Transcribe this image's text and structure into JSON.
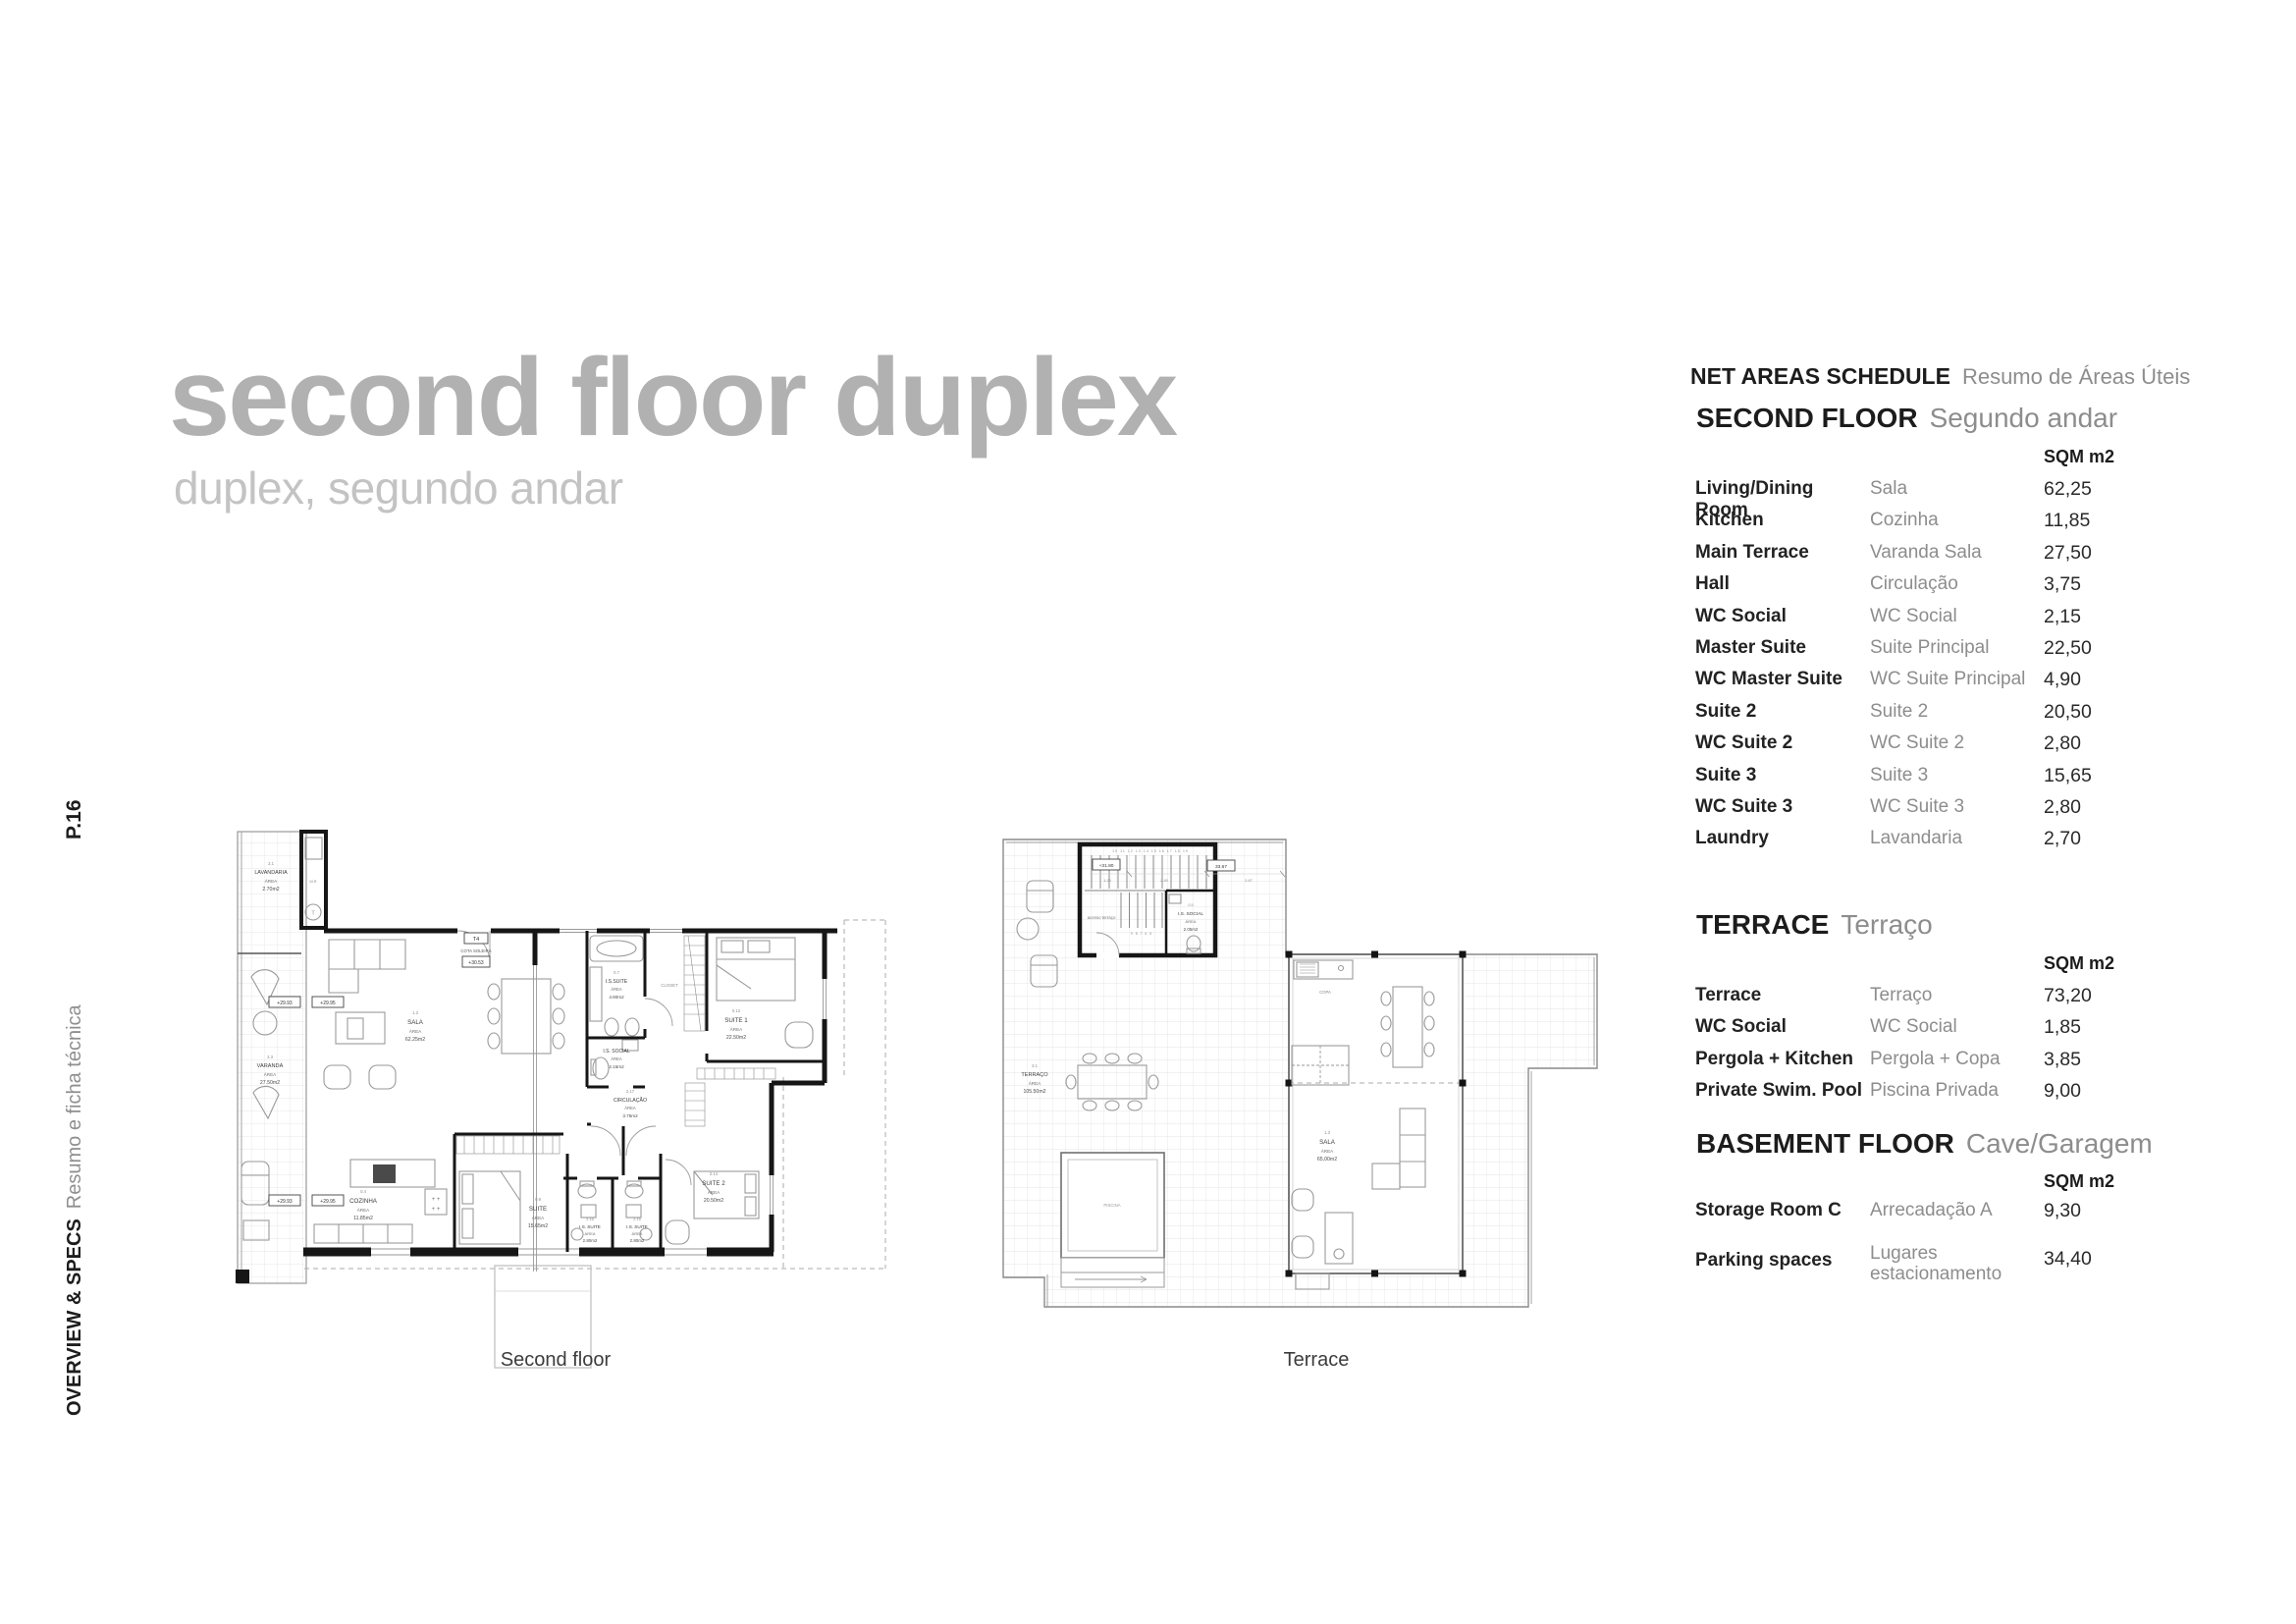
{
  "page": {
    "title": "second floor duplex",
    "subtitle": "duplex, segundo andar"
  },
  "sidebar": {
    "page_number": "P.16",
    "section_en": "OVERVIEW & SPECS",
    "section_pt": "Resumo e ficha técnica"
  },
  "schedule": {
    "title_en": "NET AREAS SCHEDULE",
    "title_pt": "Resumo de Áreas Úteis",
    "sqm_label": "SQM m2",
    "sections": [
      {
        "name_en": "SECOND FLOOR",
        "name_pt": "Segundo andar",
        "rows": [
          [
            "Living/Dining Room",
            "Sala",
            "62,25"
          ],
          [
            "Kitchen",
            "Cozinha",
            "11,85"
          ],
          [
            "Main Terrace",
            "Varanda Sala",
            "27,50"
          ],
          [
            "Hall",
            "Circulação",
            "3,75"
          ],
          [
            "WC Social",
            "WC Social",
            "2,15"
          ],
          [
            "Master Suite",
            "Suite Principal",
            "22,50"
          ],
          [
            "WC Master Suite",
            "WC Suite Principal",
            "4,90"
          ],
          [
            "Suite 2",
            "Suite 2",
            "20,50"
          ],
          [
            "WC Suite 2",
            "WC Suite 2",
            "2,80"
          ],
          [
            "Suite 3",
            "Suite 3",
            "15,65"
          ],
          [
            "WC Suite 3",
            "WC Suite 3",
            "2,80"
          ],
          [
            "Laundry",
            "Lavandaria",
            "2,70"
          ]
        ]
      },
      {
        "name_en": "TERRACE",
        "name_pt": "Terraço",
        "rows": [
          [
            "Terrace",
            "Terraço",
            "73,20"
          ],
          [
            "WC Social",
            "WC Social",
            "1,85"
          ],
          [
            "Pergola + Kitchen",
            "Pergola + Copa",
            "3,85"
          ],
          [
            "Private Swim. Pool",
            "Piscina Privada",
            "9,00"
          ]
        ]
      },
      {
        "name_en": "BASEMENT FLOOR",
        "name_pt": "Cave/Garagem",
        "rows": [
          [
            "Storage Room C",
            "Arrecadação A",
            "9,30"
          ],
          [
            "Parking spaces",
            "Lugares estacionamento",
            "34,40"
          ]
        ]
      }
    ]
  },
  "plans": {
    "second_floor": {
      "caption": "Second floor",
      "rooms": {
        "lavandaria": {
          "num": "2.1",
          "name": "LAVANDARIA",
          "aw": "ÁREA",
          "area": "2.70m2"
        },
        "mr": "M.R",
        "dryer": "T",
        "varanda": {
          "num": "2.3",
          "name": "VARANDA",
          "aw": "ÁREA",
          "area": "27.50m2"
        },
        "sala": {
          "num": "1.3",
          "name": "SALA",
          "aw": "ÁREA",
          "area": "62.25m2"
        },
        "cozinha": {
          "num": "0.4",
          "name": "COZINHA",
          "aw": "ÁREA",
          "area": "11.85m2"
        },
        "suite": {
          "num": "0.9",
          "name": "SUITE",
          "aw": "ÁREA",
          "area": "15.65m2"
        },
        "is_suite_left": {
          "num": "2.16",
          "name": "I.S. SUITE",
          "aw": "ÁREA",
          "area": "2.80m2"
        },
        "is_suite_right": {
          "num": "2.15",
          "name": "I.S. SUITE",
          "aw": "ÁREA",
          "area": "2.80m2"
        },
        "suite2": {
          "num": "2.14",
          "name": "SUITE 2",
          "aw": "ÁREA",
          "area": "20.50m2"
        },
        "suite1": {
          "num": "0.12",
          "name": "SUITE 1",
          "aw": "ÁREA",
          "area": "22.50m2"
        },
        "is_suite_top": {
          "num": "0.7",
          "name": "I.S.SUITE",
          "aw": "ÁREA",
          "area": "4.90m2"
        },
        "is_social": {
          "name": "I.S. SOCIAL",
          "aw": "ÁREA",
          "area": "2.15m2"
        },
        "circulacao": {
          "num": "2.17",
          "name": "CIRCULAÇÃO",
          "aw": "ÁREA",
          "area": "3.75m2"
        },
        "closet": "CLOSET"
      },
      "markers": {
        "t4": "T4",
        "cota_label": "COTA SOLEIRA",
        "cota_value": "+30.53",
        "lvl_a": "+29.93",
        "lvl_b": "+29.95",
        "lvl_c": "+29.93",
        "lvl_d": "+29.95"
      }
    },
    "terrace": {
      "caption": "Terrace",
      "rooms": {
        "terraco": {
          "num": "3.1",
          "name": "TERRAÇO",
          "aw": "ÁREA",
          "area": "105.50m2"
        },
        "piscina": "PISCINA",
        "sala": {
          "num": "1.3",
          "name": "SALA",
          "aw": "ÁREA",
          "area": "65,00m2"
        },
        "is_social": {
          "num": "0.5",
          "name": "I.S. SOCIAL",
          "aw": "ÁREA",
          "area": "2.05m2"
        },
        "copa": "COPA",
        "acesso": "acesso  terraço"
      },
      "markers": {
        "lvl": "+31.80",
        "dim_total": "33.67",
        "dim_1": "1.20",
        "dim_2": "2.40",
        "dim_3": "2.67",
        "stair_top": "10 11 12 13 14 15 16 17 18 19",
        "stair_bottom": "9  8  7  6  5"
      }
    }
  }
}
